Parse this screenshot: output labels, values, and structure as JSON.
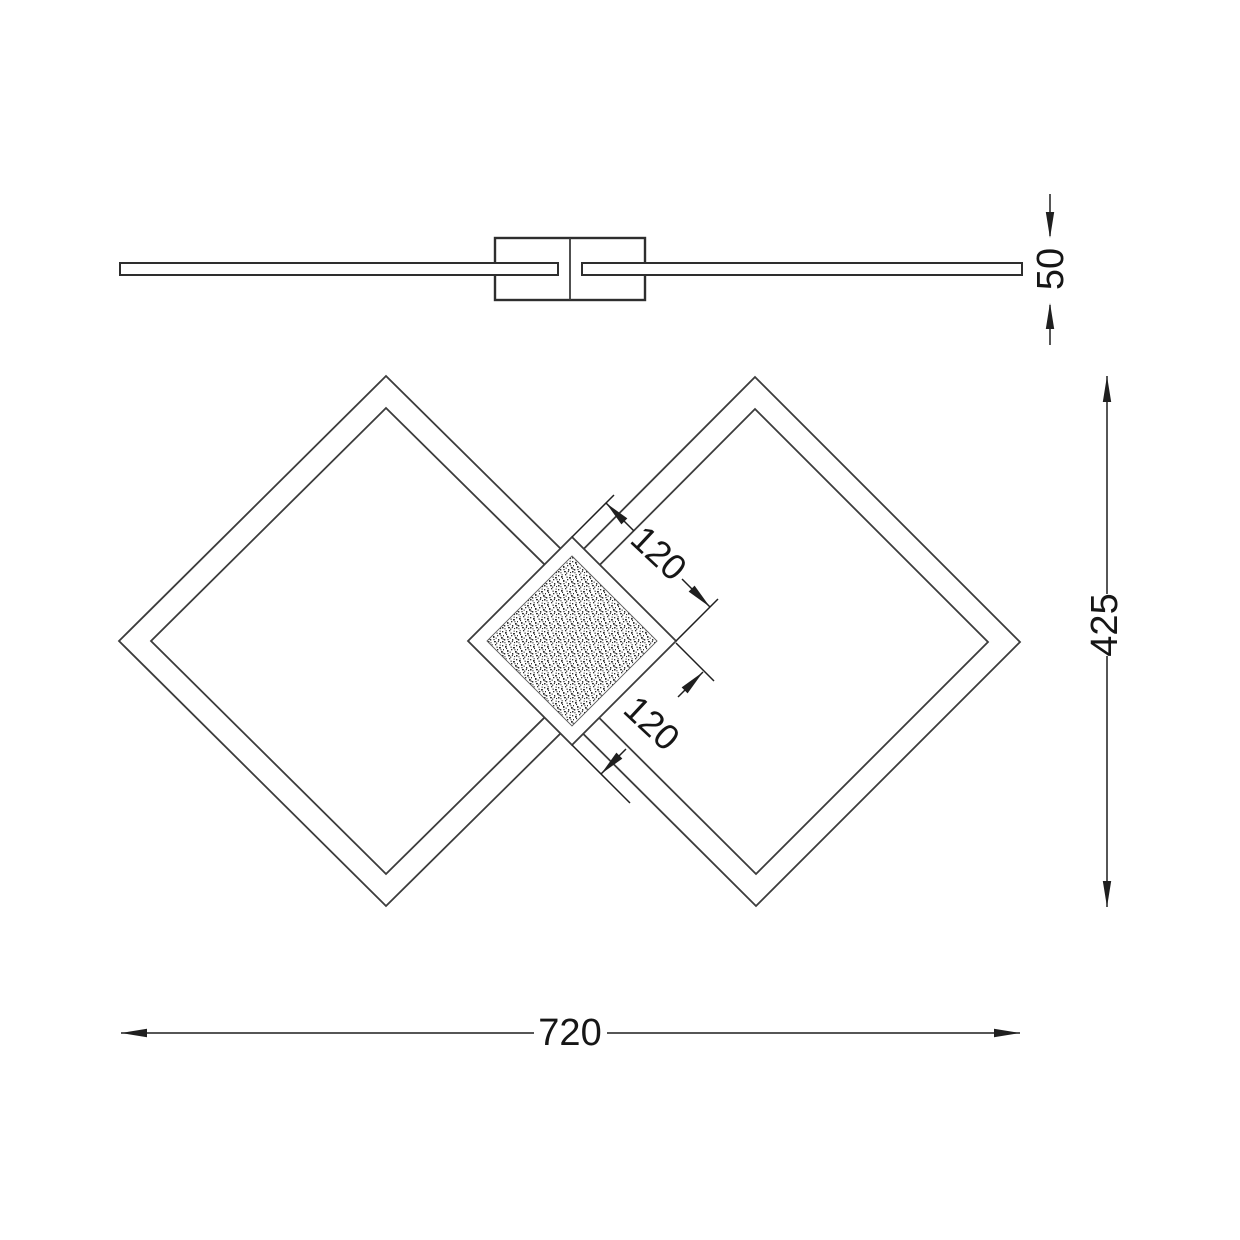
{
  "drawing": {
    "kind": "technical-dimension-drawing",
    "views": {
      "side_profile": {
        "description": "fixture seen from the side: thin rail with central mounting canopy",
        "thickness_dim": {
          "value": "50"
        }
      },
      "plan": {
        "description": "two overlapping diamond frames with stippled central square panel",
        "center_square_dims": [
          {
            "value": "120"
          },
          {
            "value": "120"
          }
        ],
        "height_dim": {
          "value": "425"
        },
        "width_dim": {
          "value": "720"
        }
      }
    },
    "colors": {
      "background": "#ffffff",
      "outline": "#3c3c3c",
      "dimension_line": "#1f1f1f",
      "dimension_text": "#161616",
      "stipple": "#2b2b2b"
    }
  }
}
